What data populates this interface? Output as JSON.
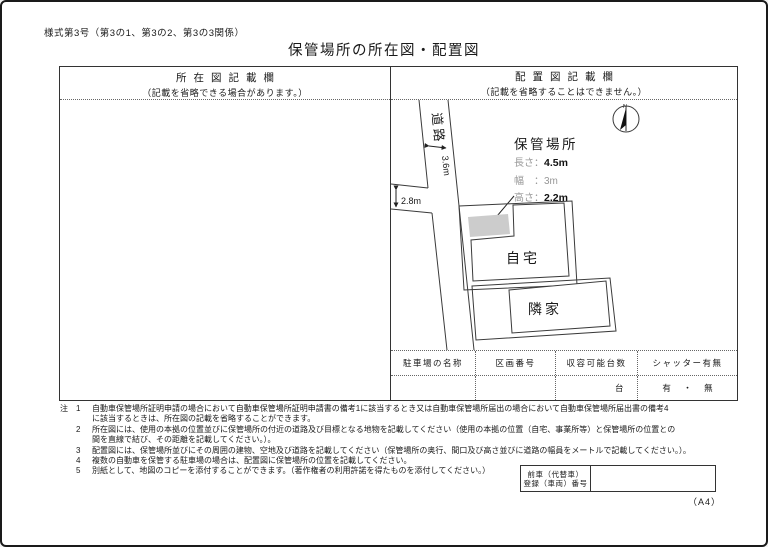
{
  "page": {
    "form_number": "様式第3号（第3の1、第3の2、第3の3関係）",
    "title": "保管場所の所在図・配置図",
    "paper_size": "（A4）"
  },
  "left_panel": {
    "header": "所在図記載欄",
    "subheader": "（記載を省略できる場合があります。）"
  },
  "right_panel": {
    "header": "配置図記載欄",
    "subheader": "（記載を省略することはできません。）"
  },
  "diagram": {
    "road_label": "道路",
    "road_width": "3.6m",
    "branch_road_width": "2.8m",
    "compass_n": "N",
    "storage_title": "保管場所",
    "length_label": "長さ：",
    "length_value": "4.5m",
    "width_label": "幅　：",
    "width_value": "3m",
    "height_label": "高さ：",
    "height_value": "2.2m",
    "own_house_label": "自宅",
    "neighbor_label": "隣家"
  },
  "placement_table": {
    "headers": [
      "駐車場の名称",
      "区画番号",
      "収容可能台数",
      "シャッター有無"
    ],
    "capacity_unit": "台",
    "shutter_options": "有 ・ 無"
  },
  "notes": {
    "marker": "注",
    "rows": [
      {
        "num": "1",
        "text": "自動車保管場所証明申請の場合において自動車保管場所証明申請書の備考1に該当するとき又は自動車保管場所届出の場合において自動車保管場所届出書の備考4"
      },
      {
        "num": "",
        "text": "に該当するときは、所在図の記載を省略することができます。"
      },
      {
        "num": "2",
        "text": "所在図には、使用の本拠の位置並びに保管場所の付近の道路及び目標となる地物を記載してください（使用の本拠の位置（自宅、事業所等）と保管場所の位置との"
      },
      {
        "num": "",
        "text": "間を直線で結び、その距離を記載してください。）。"
      },
      {
        "num": "3",
        "text": "配置図には、保管場所並びにその周囲の建物、空地及び道路を記載してください（保管場所の奥行、間口及び高さ並びに道路の幅員をメートルで記載してください。）。"
      },
      {
        "num": "4",
        "text": "複数の自動車を保管する駐車場の場合は、配置図に保管場所の位置を記載してください。"
      },
      {
        "num": "5",
        "text": "別紙として、地図のコピーを添付することができます。（著作権者の利用許諾を得たものを添付してください。）"
      }
    ]
  },
  "prev_vehicle": {
    "label_line1": "前車（代替車）",
    "label_line2": "登録（車両）番号"
  }
}
